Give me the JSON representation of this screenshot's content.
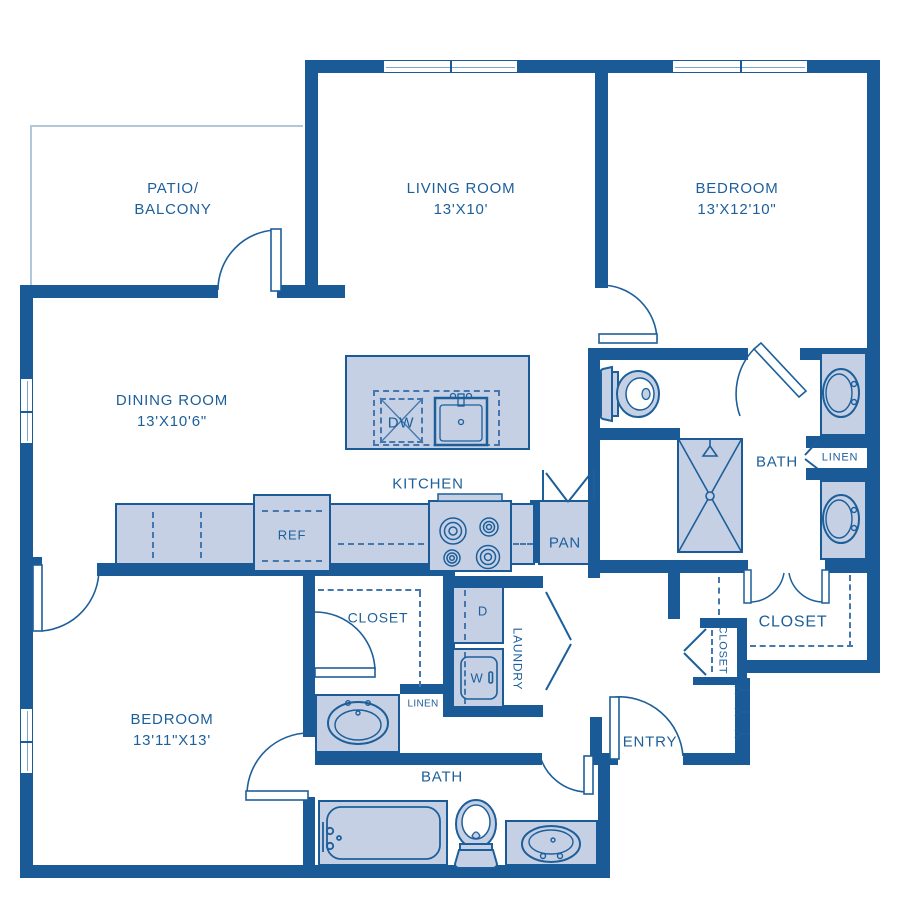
{
  "title": "Two bedroom apartment floor plan",
  "rooms": {
    "patio": {
      "line1": "PATIO/",
      "line2": "BALCONY"
    },
    "living": {
      "line1": "LIVING ROOM",
      "line2": "13'X10'"
    },
    "bedroom1": {
      "line1": "BEDROOM",
      "line2": "13'X12'10\""
    },
    "dining": {
      "line1": "DINING ROOM",
      "line2": "13'X10'6\""
    },
    "bedroom2": {
      "line1": "BEDROOM",
      "line2": "13'11\"X13'"
    },
    "kitchen": {
      "label": "KITCHEN"
    },
    "bath1": {
      "label": "BATH"
    },
    "bath2": {
      "label": "BATH"
    },
    "entry": {
      "label": "ENTRY"
    },
    "laundry": {
      "label": "LAUNDRY"
    },
    "walkin_closet": {
      "label": "CLOSET"
    },
    "small_closet": {
      "label": "CLOSET"
    },
    "bedroom2_closet": {
      "label": "CLOSET"
    },
    "linen_bath1": {
      "label": "LINEN"
    },
    "linen_bath2": {
      "label": "LINEN"
    }
  },
  "appliances": {
    "dishwasher": "DW",
    "refrigerator": "REF",
    "pantry": "PAN",
    "dryer": "D",
    "washer": "W"
  },
  "colors": {
    "wall": "#1a5a96",
    "text": "#1d5f9a",
    "fixture_fill": "#c5d0e4",
    "dashed_line": "#4377ad",
    "patio_line": "#b0c8dc",
    "background": "#ffffff"
  }
}
